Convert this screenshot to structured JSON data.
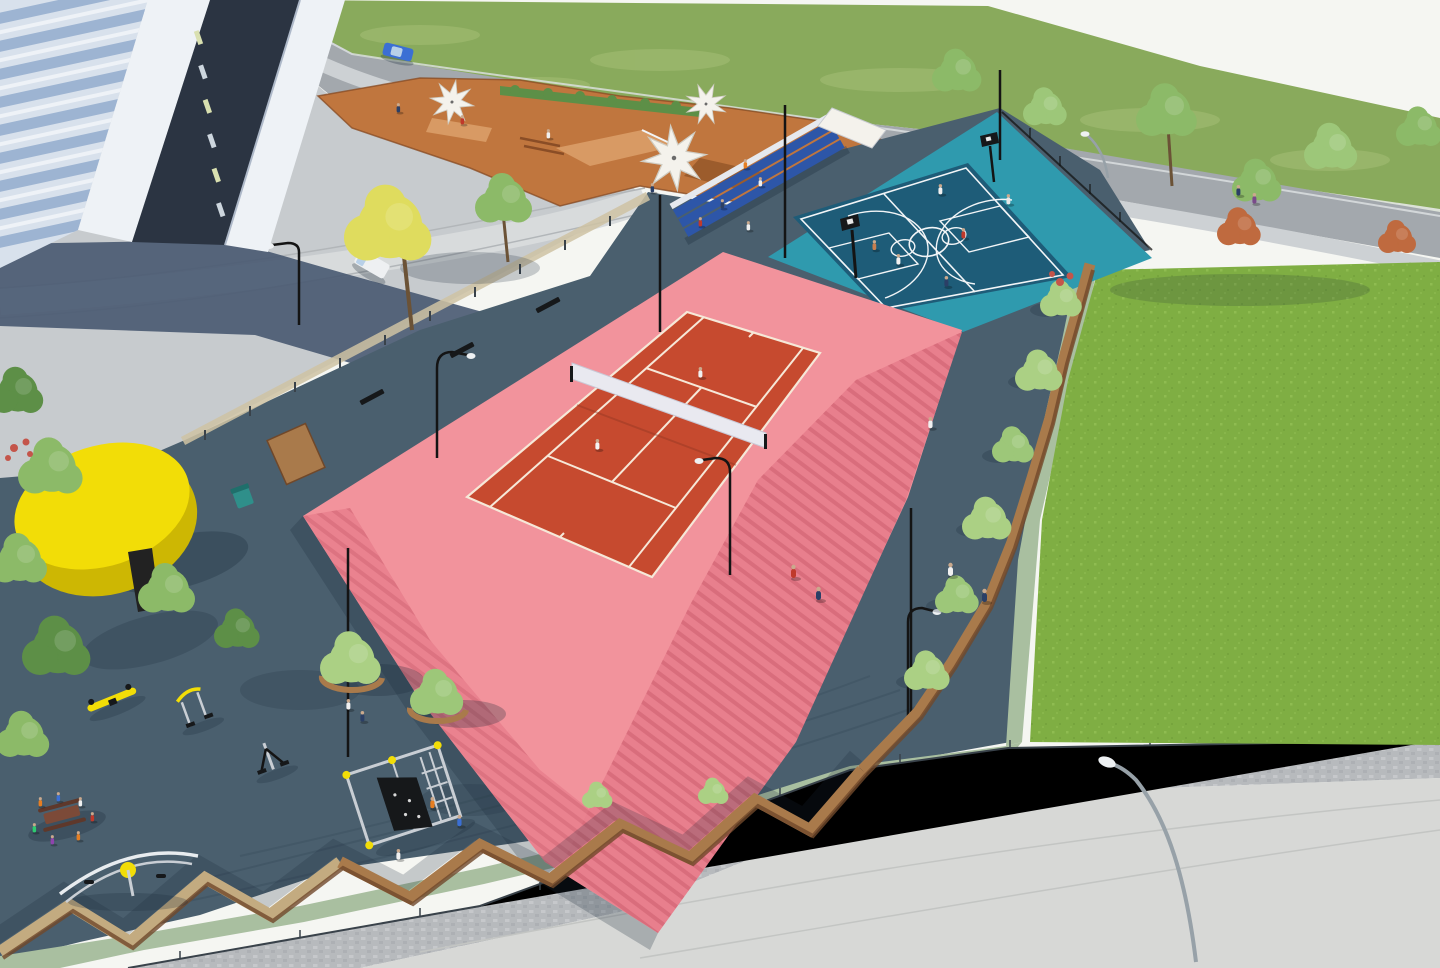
{
  "scene": {
    "kind": "3d-architectural-render",
    "view": "aerial-oblique",
    "subject": "multi-sport park between an apartment tower and a lawn",
    "time_of_day": "sunny daytime",
    "visible_text": "none"
  },
  "palette": {
    "sky": "#f5f6f2",
    "hill": "#89aa5c",
    "hillLight": "#a8c077",
    "wall": "#e6e8e5",
    "road": "#a3a8ad",
    "roadEdge": "#dfe2e4",
    "sidewalk": "#cdd1d4",
    "plaza": "#c7cbce",
    "plazaLight": "#d8dbdc",
    "curb": "#b2b6b9",
    "shadowBlue": "#485971",
    "slate": "#4a5f6e",
    "slateDark": "#394e5d",
    "skate": "#c0763e",
    "skateLight": "#d89a64",
    "skateDark": "#9c5c2c",
    "skateEdge": "#8a4d26",
    "bleacher": "#2d56a8",
    "bleacherSeat": "#e6e9ee",
    "bballApron": "#2f9aae",
    "bballCourt": "#1e5c78",
    "courtLine": "#f2f5f7",
    "tennisApron": "#f2939c",
    "tennisSide": "#e87f8d",
    "tennisSideDark": "#d96d7c",
    "tennisCourt": "#c64a2f",
    "tennisLine": "#f6e8d8",
    "netWhite": "#e9e9f0",
    "lawn": "#7fae43",
    "lawnLight": "#96c257",
    "pathGreen": "#a9bfa0",
    "cobble": "#b7babd",
    "cobbleLight": "#c9ccce",
    "concrete": "#d7d8d6",
    "seam": "#c3c5c3",
    "corten": "#a97a4b",
    "cortenDark": "#70482a",
    "fenceTan": "#c3ab80",
    "mesh": "#cfc3a4",
    "steel": "#39424a",
    "treeGreen": "#8cba68",
    "treeDark": "#5d8f47",
    "treeLight": "#abd084",
    "treeYellow": "#dfdc5e",
    "treeRed": "#bf6a3f",
    "trunk": "#6b5236",
    "flowerRed": "#c4554a",
    "pavilion": "#f2dd07",
    "pavilionDark": "#cdb703",
    "doorDark": "#222222",
    "facade": "#d8e1ec",
    "glass": "#9db4d2",
    "slabWhite": "#eef2f6",
    "coreDark": "#2b3442",
    "windowLit": "#d9e0b0",
    "windowCool": "#cdd6de",
    "binTeal": "#2f8f8a",
    "carBlue": "#3b6fd4",
    "carGlass": "#b8d0e8",
    "vanWhite": "#eef0f2",
    "lampBlack": "#141414",
    "lampSilver": "#97a1a8",
    "lampHead": "#eef1f3",
    "skin": "#caa98d",
    "picnicBrown": "#7c4a38",
    "equipSilver": "#c9ced4",
    "equipYellow": "#f2dd07",
    "panelBlack": "#16181a",
    "shadow": "#1c2b3a"
  },
  "inventory": {
    "courts": [
      {
        "name": "tennis-court",
        "surface": "red on raised pink platform with striped side faces",
        "players": 2,
        "features": [
          "net",
          "white markings",
          "perimeter light poles",
          "black net posts"
        ]
      },
      {
        "name": "basketball-court",
        "surface": "dark blue court on teal apron",
        "players": 6,
        "features": [
          "two hoops",
          "white markings",
          "center circle",
          "three-point arcs"
        ]
      }
    ],
    "zones": [
      {
        "name": "skate-park",
        "surface": "terracotta",
        "features": [
          "ramps",
          "grind boxes",
          "3 white star shade umbrellas",
          "skaters"
        ]
      },
      {
        "name": "playground",
        "surface": "dark slate rubber",
        "equipment": [
          "climbing frame with black panel",
          "arc swing carousel",
          "yellow seesaw springer",
          "two outdoor-gym machines",
          "picnic table with children"
        ]
      },
      {
        "name": "lawn",
        "surface": "bright green grass"
      },
      {
        "name": "entry-plaza",
        "surface": "light concrete with curved walkway"
      },
      {
        "name": "street",
        "features": [
          "retaining wall",
          "sidewalk",
          "grass hillside"
        ]
      }
    ],
    "buildings": [
      {
        "name": "apartment-tower",
        "style": "glass balconies, white pilasters, dark core with window slits"
      },
      {
        "name": "yellow-pavilion",
        "style": "round kiosk with dark doorway"
      }
    ],
    "site_furniture": [
      {
        "name": "bleachers",
        "color": "blue",
        "rows": 3
      },
      {
        "name": "benches",
        "count": 3
      },
      {
        "name": "litter-bin",
        "color": "teal"
      },
      {
        "name": "corten-planters-with-trees",
        "count": 6
      },
      {
        "name": "street-lamps",
        "count": 6
      },
      {
        "name": "fences",
        "types": [
          "bronze mesh (north-west)",
          "corten zig-zag (south & east)",
          "thin steel rail (outer)"
        ]
      }
    ],
    "vehicles": [
      {
        "name": "blue-car",
        "location": "top street"
      },
      {
        "name": "white-car",
        "location": "top street"
      },
      {
        "name": "white-van",
        "location": "plaza"
      }
    ],
    "vegetation": {
      "green_trees": 20,
      "yellow_tree": 1,
      "red_trees": 2,
      "hedge_rows": 1,
      "flower_clusters": 2
    },
    "people_total_approx": 36
  }
}
